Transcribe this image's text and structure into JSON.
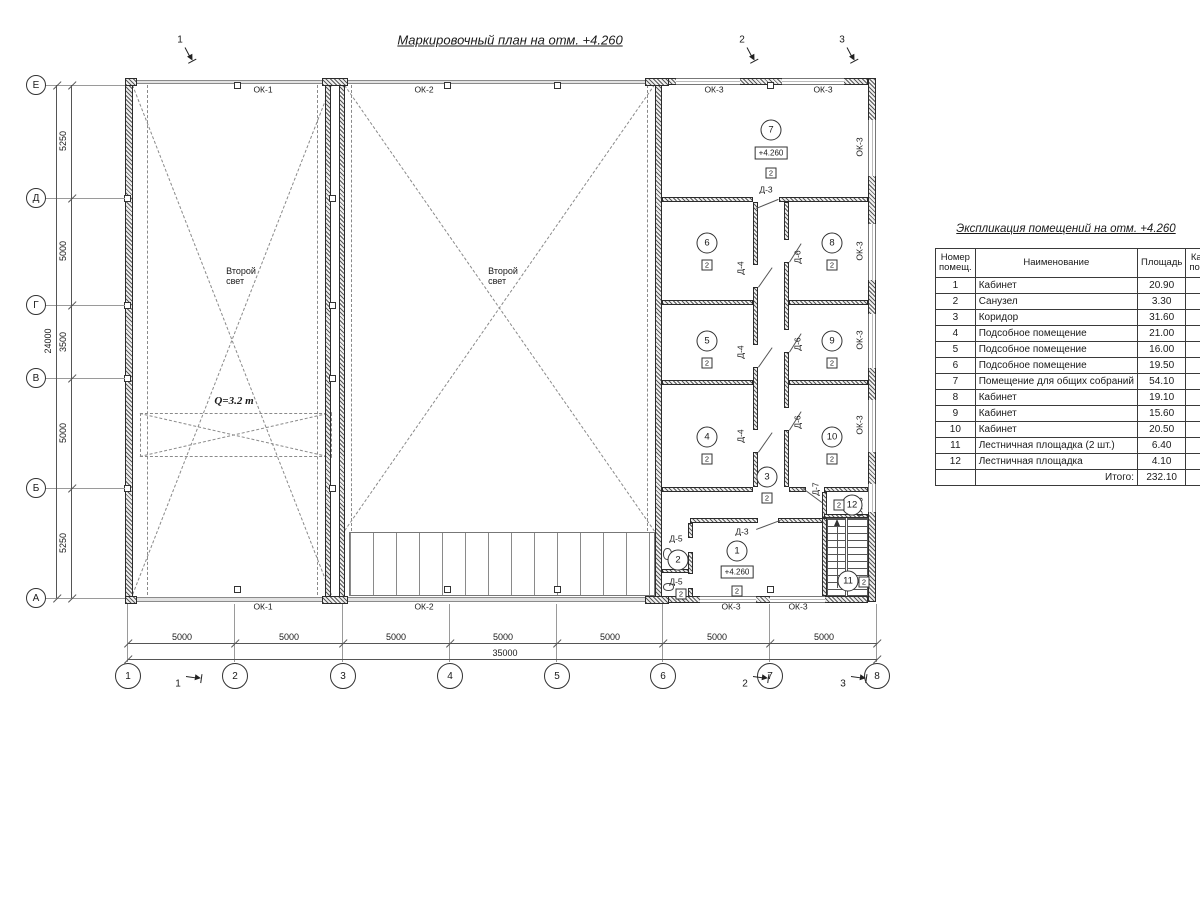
{
  "drawing_title": "Маркировочный план на отм. +4.260",
  "elevation_text": "+4.260",
  "category_text": "2",
  "axes": {
    "rows": [
      [
        "Е",
        85
      ],
      [
        "Д",
        198
      ],
      [
        "Г",
        305
      ],
      [
        "В",
        378
      ],
      [
        "Б",
        488
      ],
      [
        "А",
        598
      ]
    ],
    "cols": [
      [
        "1",
        128
      ],
      [
        "2",
        235
      ],
      [
        "3",
        343
      ],
      [
        "4",
        450
      ],
      [
        "5",
        557
      ],
      [
        "6",
        663
      ],
      [
        "7",
        770
      ],
      [
        "8",
        877
      ]
    ]
  },
  "dims": {
    "v_segments": [
      [
        "5250",
        141
      ],
      [
        "5000",
        251
      ],
      [
        "3500",
        342
      ],
      [
        "5000",
        433
      ],
      [
        "5250",
        543
      ]
    ],
    "v_total": "24000",
    "h_segments": [
      [
        "5000",
        182
      ],
      [
        "5000",
        289
      ],
      [
        "5000",
        396
      ],
      [
        "5000",
        503
      ],
      [
        "5000",
        610
      ],
      [
        "5000",
        717
      ],
      [
        "5000",
        824
      ]
    ],
    "h_total": "35000"
  },
  "marks_top": [
    [
      "1",
      180,
      40
    ],
    [
      "2",
      742,
      40
    ],
    [
      "3",
      842,
      40
    ]
  ],
  "marks_bottom": [
    [
      "1",
      178,
      684
    ],
    [
      "2",
      745,
      684
    ],
    [
      "3",
      843,
      684
    ]
  ],
  "labels": [
    {
      "t": "ОК-1",
      "x": 263,
      "y": 90
    },
    {
      "t": "ОК-2",
      "x": 424,
      "y": 90
    },
    {
      "t": "ОК-3",
      "x": 714,
      "y": 90
    },
    {
      "t": "ОК-3",
      "x": 823,
      "y": 90
    },
    {
      "t": "ОК-1",
      "x": 263,
      "y": 607
    },
    {
      "t": "ОК-2",
      "x": 424,
      "y": 607
    },
    {
      "t": "ОК-3",
      "x": 731,
      "y": 607
    },
    {
      "t": "ОК-3",
      "x": 798,
      "y": 607
    },
    {
      "t": "ОК-3",
      "x": 860,
      "y": 147,
      "r": -90
    },
    {
      "t": "ОК-3",
      "x": 860,
      "y": 251,
      "r": -90
    },
    {
      "t": "ОК-3",
      "x": 860,
      "y": 340,
      "r": -90
    },
    {
      "t": "ОК-3",
      "x": 860,
      "y": 425,
      "r": -90
    },
    {
      "t": "ОК-3",
      "x": 860,
      "y": 507,
      "r": -90
    },
    {
      "t": "Д-3",
      "x": 766,
      "y": 190
    },
    {
      "t": "Д-3",
      "x": 742,
      "y": 532
    },
    {
      "t": "Д-4",
      "x": 741,
      "y": 268,
      "r": -90
    },
    {
      "t": "Д-4",
      "x": 741,
      "y": 352,
      "r": -90
    },
    {
      "t": "Д-4",
      "x": 741,
      "y": 436,
      "r": -90
    },
    {
      "t": "Д-6",
      "x": 798,
      "y": 257,
      "r": -90
    },
    {
      "t": "Д-6",
      "x": 798,
      "y": 344,
      "r": -90
    },
    {
      "t": "Д-6",
      "x": 798,
      "y": 422,
      "r": -90
    },
    {
      "t": "Д-5",
      "x": 676,
      "y": 539
    },
    {
      "t": "Д-5",
      "x": 676,
      "y": 582
    },
    {
      "t": "Д-7",
      "x": 816,
      "y": 489,
      "r": -90
    },
    {
      "t": "Второй\nсвет",
      "x": 241,
      "y": 276,
      "cls": "two"
    },
    {
      "t": "Второй\nсвет",
      "x": 503,
      "y": 276,
      "cls": "two"
    },
    {
      "t": "Q=3.2 т",
      "x": 234,
      "y": 401,
      "cls": "crane"
    }
  ],
  "rooms": [
    {
      "n": "7",
      "x": 771,
      "y": 130,
      "elev": [
        771,
        153
      ],
      "cat": [
        771,
        173
      ]
    },
    {
      "n": "6",
      "x": 707,
      "y": 243,
      "cat": [
        707,
        265
      ]
    },
    {
      "n": "8",
      "x": 832,
      "y": 243,
      "cat": [
        832,
        265
      ]
    },
    {
      "n": "5",
      "x": 707,
      "y": 341,
      "cat": [
        707,
        363
      ]
    },
    {
      "n": "9",
      "x": 832,
      "y": 341,
      "cat": [
        832,
        363
      ]
    },
    {
      "n": "4",
      "x": 707,
      "y": 437,
      "cat": [
        707,
        459
      ]
    },
    {
      "n": "10",
      "x": 832,
      "y": 437,
      "cat": [
        832,
        459
      ]
    },
    {
      "n": "3",
      "x": 767,
      "y": 477,
      "cat": [
        767,
        498
      ]
    },
    {
      "n": "1",
      "x": 737,
      "y": 551,
      "elev": [
        737,
        572
      ],
      "cat": [
        737,
        591
      ]
    },
    {
      "n": "2",
      "x": 678,
      "y": 560,
      "cat": [
        681,
        594
      ]
    },
    {
      "n": "12",
      "x": 852,
      "y": 505,
      "cat": [
        839,
        505
      ]
    },
    {
      "n": "11",
      "x": 848,
      "y": 581,
      "cat": [
        864,
        582
      ]
    }
  ],
  "geometry": {
    "walls_hatch": [
      [
        125,
        78,
        8,
        524
      ],
      [
        868,
        78,
        8,
        524
      ],
      [
        325,
        84,
        6,
        514
      ],
      [
        339,
        84,
        6,
        514
      ],
      [
        655,
        82,
        7,
        516
      ],
      [
        662,
        78,
        206,
        7
      ],
      [
        662,
        596,
        206,
        7
      ],
      [
        322,
        78,
        26,
        8
      ],
      [
        322,
        596,
        26,
        8
      ],
      [
        125,
        78,
        12,
        8
      ],
      [
        125,
        596,
        12,
        8
      ],
      [
        645,
        78,
        24,
        8
      ],
      [
        645,
        596,
        24,
        8
      ],
      [
        662,
        197,
        91,
        5
      ],
      [
        779,
        197,
        89,
        5
      ],
      [
        662,
        300,
        91,
        5
      ],
      [
        789,
        300,
        79,
        5
      ],
      [
        662,
        380,
        91,
        5
      ],
      [
        789,
        380,
        79,
        5
      ],
      [
        662,
        487,
        91,
        5
      ],
      [
        789,
        487,
        17,
        5
      ],
      [
        824,
        487,
        44,
        5
      ],
      [
        690,
        518,
        68,
        5
      ],
      [
        778,
        518,
        46,
        5
      ],
      [
        753,
        202,
        5,
        63
      ],
      [
        753,
        287,
        5,
        58
      ],
      [
        753,
        367,
        5,
        63
      ],
      [
        753,
        452,
        5,
        35
      ],
      [
        784,
        202,
        5,
        38
      ],
      [
        784,
        262,
        5,
        68
      ],
      [
        784,
        352,
        5,
        56
      ],
      [
        784,
        430,
        5,
        57
      ],
      [
        688,
        523,
        5,
        15
      ],
      [
        688,
        552,
        5,
        22
      ],
      [
        688,
        588,
        5,
        9
      ],
      [
        662,
        569,
        27,
        4
      ],
      [
        822,
        518,
        5,
        78
      ],
      [
        822,
        492,
        5,
        26
      ],
      [
        824,
        514,
        44,
        4
      ]
    ],
    "walls_thin": [
      [
        133,
        80,
        522,
        4
      ],
      [
        133,
        597,
        522,
        5
      ]
    ],
    "windows_h": [
      [
        676,
        78,
        64,
        7
      ],
      [
        782,
        78,
        62,
        7
      ],
      [
        700,
        596,
        56,
        7
      ],
      [
        770,
        596,
        55,
        7
      ]
    ],
    "windows_v": [
      [
        868,
        120,
        8,
        56
      ],
      [
        868,
        224,
        8,
        56
      ],
      [
        868,
        314,
        8,
        54
      ],
      [
        868,
        400,
        8,
        52
      ],
      [
        868,
        484,
        8,
        28
      ]
    ],
    "columns": [
      [
        237,
        85
      ],
      [
        447,
        85
      ],
      [
        557,
        85
      ],
      [
        770,
        85
      ],
      [
        237,
        589
      ],
      [
        447,
        589
      ],
      [
        557,
        589
      ],
      [
        770,
        589
      ],
      [
        127,
        198
      ],
      [
        127,
        305
      ],
      [
        127,
        378
      ],
      [
        127,
        488
      ],
      [
        332,
        198
      ],
      [
        332,
        305
      ],
      [
        332,
        378
      ],
      [
        332,
        488
      ]
    ],
    "dashed_lines": [
      [
        133,
        85,
        332,
        595
      ],
      [
        332,
        85,
        133,
        595
      ],
      [
        148,
        85,
        148,
        595
      ],
      [
        318,
        85,
        318,
        595
      ],
      [
        345,
        85,
        655,
        531
      ],
      [
        655,
        85,
        345,
        531
      ],
      [
        352,
        85,
        352,
        531
      ],
      [
        648,
        85,
        648,
        531
      ],
      [
        140,
        413,
        332,
        457
      ],
      [
        332,
        413,
        140,
        457
      ]
    ],
    "crane_rect": [
      140,
      413,
      192,
      44
    ],
    "solid_lines": [
      [
        756,
        208,
        778,
        199
      ],
      [
        756,
        529,
        780,
        520
      ],
      [
        803,
        488,
        822,
        502
      ],
      [
        758,
        287,
        772,
        267
      ],
      [
        758,
        367,
        772,
        347
      ],
      [
        758,
        452,
        772,
        432
      ],
      [
        789,
        262,
        801,
        243
      ],
      [
        789,
        352,
        801,
        333
      ],
      [
        789,
        430,
        801,
        411
      ]
    ],
    "platform": [
      349,
      532,
      306,
      64
    ],
    "stairs": [
      827,
      518,
      41,
      78
    ],
    "stair_divider": [
      845,
      518,
      3,
      78
    ],
    "stair_arrow_line": [
      837,
      588,
      837,
      526
    ],
    "stair_arrow_head": [
      834,
      519
    ],
    "fixtures": [
      [
        663,
        548,
        9,
        12
      ],
      [
        663,
        583,
        11,
        8
      ]
    ]
  },
  "table": {
    "title": "Экспликация помещений на отм. +4.260",
    "headers": [
      "Номер помещ.",
      "Наименование",
      "Площадь",
      "Кат. пом."
    ],
    "col_widths": [
      40,
      158,
      45,
      20
    ],
    "rows": [
      [
        "1",
        "Кабинет",
        "20.90",
        ""
      ],
      [
        "2",
        "Санузел",
        "3.30",
        ""
      ],
      [
        "3",
        "Коридор",
        "31.60",
        ""
      ],
      [
        "4",
        "Подсобное помещение",
        "21.00",
        ""
      ],
      [
        "5",
        "Подсобное помещение",
        "16.00",
        ""
      ],
      [
        "6",
        "Подсобное помещение",
        "19.50",
        ""
      ],
      [
        "7",
        "Помещение для общих собраний",
        "54.10",
        ""
      ],
      [
        "8",
        "Кабинет",
        "19.10",
        ""
      ],
      [
        "9",
        "Кабинет",
        "15.60",
        ""
      ],
      [
        "10",
        "Кабинет",
        "20.50",
        ""
      ],
      [
        "11",
        "Лестничная площадка (2 шт.)",
        "6.40",
        ""
      ],
      [
        "12",
        "Лестничная площадка",
        "4.10",
        ""
      ]
    ],
    "total_label": "Итого:",
    "total_value": "232.10"
  }
}
